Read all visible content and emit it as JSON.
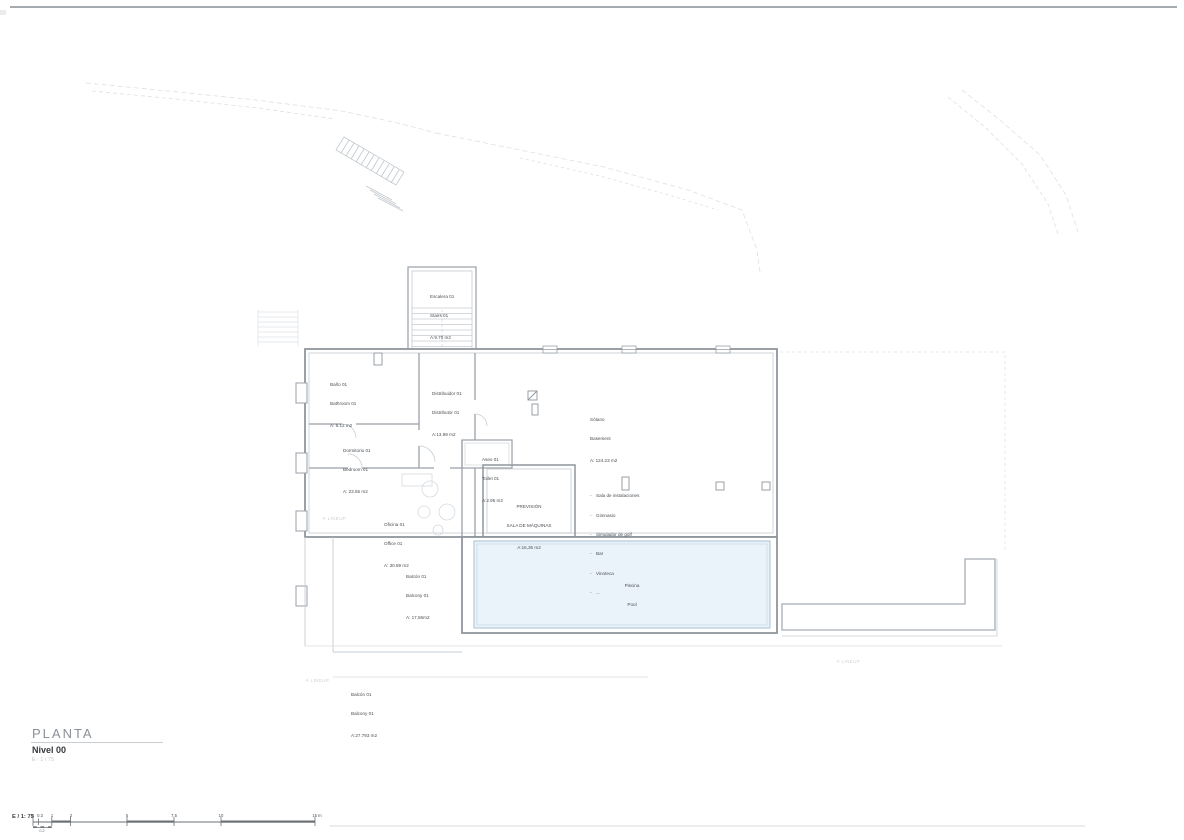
{
  "title_block": {
    "title": "PLANTA",
    "level": "Nivel 00",
    "scale": "E : 1 / 75"
  },
  "scalebar": {
    "label": "E / 1: 75",
    "ticks": [
      "0",
      "0.3",
      "1",
      "2",
      "5",
      "7.5",
      "10",
      "15 m"
    ],
    "sub_tick": "0.2"
  },
  "watermark": {
    "icon": "✳",
    "text": "LINEUP"
  },
  "rooms": {
    "stairs": {
      "name_es": "Escalera 01",
      "name_en": "Stairs 01",
      "area": "A:9.70 m2"
    },
    "bathroom": {
      "name_es": "Baño 01",
      "name_en": "Bathroom 01",
      "area": "A: 6.12 m2"
    },
    "hall": {
      "name_es": "Distribuidor 01",
      "name_en": "Distributor 01",
      "area": "A:13.99 m2"
    },
    "bedroom": {
      "name_es": "Dormitorio 01",
      "name_en": "Bedroom 01",
      "area": "A: 23.55 m2"
    },
    "toilet": {
      "name_es": "Aseo 01",
      "name_en": "Toilet 01",
      "area": "A:2.95 m2"
    },
    "basement": {
      "name_es": "Sótano",
      "name_en": "Basement",
      "area": "A: 124.23 m2",
      "uses": [
        "Sala de instalaciones",
        "Gimnasio",
        "Simulador de golf",
        "Bar",
        "Vinoteca",
        "..."
      ]
    },
    "machine_room": {
      "line1": "PREVISIÓN",
      "line2": "SALA DE MÁQUINAS",
      "area": "A:16,36 m2"
    },
    "office": {
      "name_es": "Oficina 01",
      "name_en": "Office 01",
      "area": "A: 30.89 m2"
    },
    "balcony_upper": {
      "name_es": "Balcón 01",
      "name_en": "Balcony 01",
      "area": "A: 17,56m2"
    },
    "pool": {
      "name_es": "Piscina",
      "name_en": "Pool"
    },
    "balcony_lower": {
      "name_es": "Balcón 01",
      "name_en": "Balcony 01",
      "area": "A:27.793 m2"
    }
  },
  "colors": {
    "pool_fill": "#eaf3fa",
    "pool_stroke": "#a9bfd2",
    "wall": "#8f969d",
    "line_faint": "#d9dee3",
    "text": "#4a4f54"
  }
}
